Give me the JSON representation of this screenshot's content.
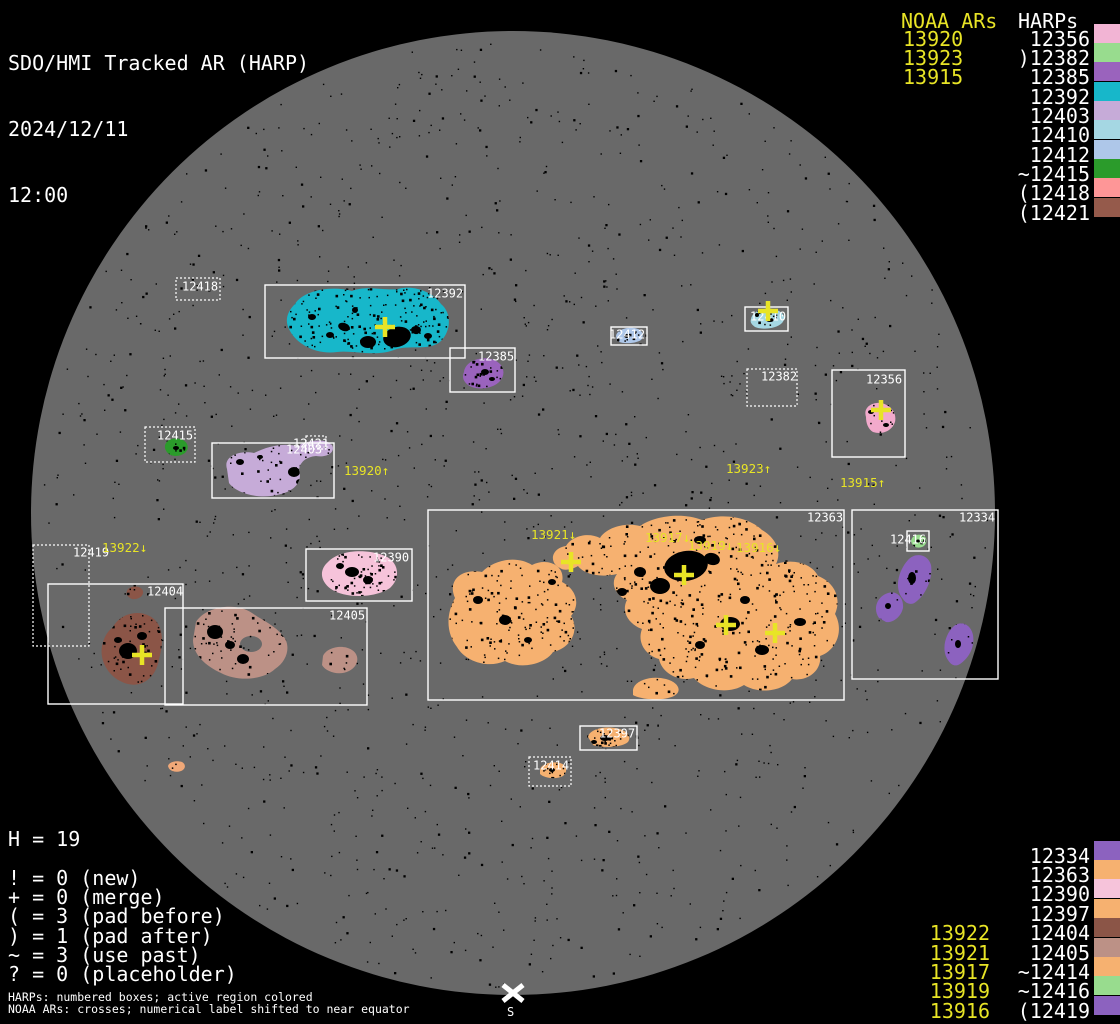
{
  "title": {
    "app": "SDO/HMI Tracked AR (HARP)",
    "date": "2024/12/11",
    "time": "12:00"
  },
  "colors": {
    "background": "#000000",
    "disk": "#696969",
    "noaa": "#e8e426",
    "harp_text": "#ffffff"
  },
  "legend_top_right": {
    "noaa_header": "NOAA ARs",
    "harps_header": "HARPs",
    "rows": [
      {
        "noaa": "13920",
        "harp": "12356",
        "color": "#f2b4d4"
      },
      {
        "noaa": "13923",
        "harp": ")12382",
        "color": "#98dc8e"
      },
      {
        "noaa": "13915",
        "harp": "12385",
        "color": "#9a63bd"
      },
      {
        "noaa": "",
        "harp": "12392",
        "color": "#17b7ca"
      },
      {
        "noaa": "",
        "harp": "12403",
        "color": "#c6abd8"
      },
      {
        "noaa": "",
        "harp": "12410",
        "color": "#a5d7e3"
      },
      {
        "noaa": "",
        "harp": "12412",
        "color": "#aec7e9"
      },
      {
        "noaa": "",
        "harp": "~12415",
        "color": "#2b9b2b"
      },
      {
        "noaa": "",
        "harp": "(12418",
        "color": "#fe9697"
      },
      {
        "noaa": "",
        "harp": "(12421",
        "color": "#955a4b"
      }
    ]
  },
  "legend_bottom_right": {
    "rows": [
      {
        "noaa": "",
        "harp": "12334",
        "color": "#8c62bf"
      },
      {
        "noaa": "",
        "harp": "12363",
        "color": "#f6b170"
      },
      {
        "noaa": "",
        "harp": "12390",
        "color": "#f6c3da"
      },
      {
        "noaa": "",
        "harp": "12397",
        "color": "#f6b170"
      },
      {
        "noaa": "13922",
        "harp": "12404",
        "color": "#8b5547"
      },
      {
        "noaa": "13921",
        "harp": "12405",
        "color": "#bc9186"
      },
      {
        "noaa": "13917",
        "harp": "~12414",
        "color": "#f6b170"
      },
      {
        "noaa": "13919",
        "harp": "~12416",
        "color": "#98dc8e"
      },
      {
        "noaa": "13916",
        "harp": "(12419",
        "color": "#8c62bf"
      }
    ]
  },
  "stats": {
    "title": "H = 19",
    "lines": [
      "! = 0 (new)",
      "+ = 0 (merge)",
      "( = 3 (pad before)",
      ") = 1 (pad after)",
      "~ = 3 (use past)",
      "? = 0 (placeholder)"
    ]
  },
  "footnotes": [
    "HARPs: numbered boxes; active region colored",
    "NOAA ARs: crosses; numerical label shifted to near equator"
  ],
  "south_marker": {
    "label": "S"
  },
  "disk": {
    "cx": 513,
    "cy": 513,
    "r": 482,
    "color": "#696969"
  },
  "noise": {
    "count": 1500,
    "seed": 7
  },
  "harp_boxes": [
    {
      "label": "12418",
      "x": 176,
      "y": 278,
      "w": 44,
      "h": 22,
      "style": "dotted",
      "lx": 182,
      "ly": 281
    },
    {
      "label": "12392",
      "x": 265,
      "y": 285,
      "w": 200,
      "h": 73,
      "style": "solid",
      "lx": 427,
      "ly": 288
    },
    {
      "label": "12385",
      "x": 450,
      "y": 348,
      "w": 65,
      "h": 44,
      "style": "solid",
      "lx": 478,
      "ly": 351
    },
    {
      "label": "12415",
      "x": 145,
      "y": 427,
      "w": 50,
      "h": 35,
      "style": "dotted",
      "lx": 157,
      "ly": 430
    },
    {
      "label": "12403",
      "x": 212,
      "y": 443,
      "w": 122,
      "h": 55,
      "style": "solid",
      "lx": 286,
      "ly": 444
    },
    {
      "label": "12421",
      "x": 306,
      "y": 436,
      "w": 20,
      "h": 13,
      "style": "dotted",
      "lx": 293,
      "ly": 438
    },
    {
      "label": "12419",
      "x": 33,
      "y": 545,
      "w": 56,
      "h": 101,
      "style": "dotted",
      "lx": 73,
      "ly": 547
    },
    {
      "label": "12404",
      "x": 48,
      "y": 584,
      "w": 135,
      "h": 120,
      "style": "solid",
      "lx": 147,
      "ly": 586
    },
    {
      "label": "12405",
      "x": 165,
      "y": 608,
      "w": 202,
      "h": 97,
      "style": "solid",
      "lx": 329,
      "ly": 610
    },
    {
      "label": "12390",
      "x": 306,
      "y": 549,
      "w": 106,
      "h": 52,
      "style": "solid",
      "lx": 373,
      "ly": 552
    },
    {
      "label": "12363",
      "x": 428,
      "y": 510,
      "w": 416,
      "h": 190,
      "style": "solid",
      "lx": 807,
      "ly": 512
    },
    {
      "label": "12334",
      "x": 852,
      "y": 510,
      "w": 146,
      "h": 169,
      "style": "solid",
      "lx": 959,
      "ly": 512
    },
    {
      "label": "12416",
      "x": 907,
      "y": 531,
      "w": 22,
      "h": 20,
      "style": "solid",
      "lx": 890,
      "ly": 534
    },
    {
      "label": "12356",
      "x": 832,
      "y": 370,
      "w": 73,
      "h": 87,
      "style": "solid",
      "lx": 866,
      "ly": 374
    },
    {
      "label": "12382",
      "x": 747,
      "y": 369,
      "w": 50,
      "h": 37,
      "style": "dotted",
      "lx": 761,
      "ly": 371
    },
    {
      "label": "12410",
      "x": 745,
      "y": 307,
      "w": 43,
      "h": 24,
      "style": "solid",
      "lx": 750,
      "ly": 311
    },
    {
      "label": "12412",
      "x": 611,
      "y": 327,
      "w": 36,
      "h": 18,
      "style": "solid",
      "lx": 609,
      "ly": 329
    },
    {
      "label": "12397",
      "x": 580,
      "y": 726,
      "w": 57,
      "h": 24,
      "style": "solid",
      "lx": 599,
      "ly": 728
    },
    {
      "label": "12414",
      "x": 529,
      "y": 757,
      "w": 42,
      "h": 29,
      "style": "dotted",
      "lx": 533,
      "ly": 760
    }
  ],
  "noaa_crosses": [
    [
      385,
      327
    ],
    [
      768,
      311
    ],
    [
      881,
      410
    ],
    [
      142,
      655
    ],
    [
      571,
      562
    ],
    [
      684,
      575
    ],
    [
      726,
      625
    ],
    [
      775,
      633
    ]
  ],
  "noaa_disk_labels": [
    {
      "text": "13920↑",
      "x": 344,
      "y": 465
    },
    {
      "text": "13922↓",
      "x": 102,
      "y": 542
    },
    {
      "text": "13921↓",
      "x": 531,
      "y": 529
    },
    {
      "text": "13917↓",
      "x": 645,
      "y": 532
    },
    {
      "text": "13919↓",
      "x": 688,
      "y": 540
    },
    {
      "text": "13916↓",
      "x": 736,
      "y": 542
    },
    {
      "text": "13923↑",
      "x": 726,
      "y": 463
    },
    {
      "text": "13915↑",
      "x": 840,
      "y": 477
    }
  ],
  "active_regions": [
    {
      "harp": "12392",
      "color": "#17b7ca",
      "speckles": 210,
      "paths": [
        "M295,304 C303,291 330,285 352,291 C366,285 386,291 398,289 C414,284 434,293 441,304 C452,313 451,331 441,341 C429,352 408,344 394,350 C376,357 352,350 337,352 C316,355 297,344 290,331 C284,321 287,312 295,304 Z"
      ],
      "clusters": [
        [
          397,
          337,
          14,
          10,
          -15
        ],
        [
          368,
          342,
          8,
          6,
          0
        ],
        [
          344,
          327,
          6,
          4,
          20
        ],
        [
          416,
          330,
          5,
          4,
          0
        ],
        [
          312,
          317,
          4,
          3,
          0
        ],
        [
          330,
          335,
          4,
          3,
          0
        ],
        [
          428,
          336,
          4,
          3,
          0
        ],
        [
          355,
          310,
          3,
          3,
          0
        ]
      ]
    },
    {
      "harp": "12385",
      "color": "#9a63bd",
      "speckles": 30,
      "paths": [
        "M464,372 C465,362 479,356 491,359 C503,362 507,373 500,381 C493,389 477,391 468,385 C463,381 462,377 464,372 Z"
      ],
      "clusters": [
        [
          485,
          372,
          4,
          3,
          0
        ],
        [
          492,
          379,
          3,
          2,
          0
        ]
      ]
    },
    {
      "harp": "12415",
      "color": "#2b9b2b",
      "speckles": 10,
      "paths": [
        "M165,448 C164,441 172,437 180,439 C188,441 190,448 185,453 C178,458 167,457 165,448 Z"
      ],
      "clusters": [
        [
          176,
          448,
          3,
          2,
          0
        ]
      ]
    },
    {
      "harp": "12403",
      "color": "#c6abd8",
      "speckles": 55,
      "paths": [
        "M227,469 C223,457 238,450 254,453 C268,446 283,443 297,446 C308,440 326,438 332,445 C336,452 327,458 316,456 C306,457 300,462 299,470 C303,482 294,492 277,495 C259,499 237,494 229,483 Z"
      ],
      "clusters": [
        [
          294,
          472,
          6,
          5,
          0
        ],
        [
          300,
          482,
          4,
          3,
          0
        ],
        [
          240,
          462,
          4,
          3,
          0
        ],
        [
          260,
          457,
          3,
          2,
          0
        ]
      ]
    },
    {
      "harp": "12390",
      "color": "#f6c3da",
      "speckles": 80,
      "paths": [
        "M328,562 C339,550 366,548 385,556 C399,562 401,578 390,588 C376,598 345,599 331,589 C320,581 319,570 328,562 Z"
      ],
      "clusters": [
        [
          352,
          572,
          7,
          5,
          0
        ],
        [
          368,
          580,
          5,
          4,
          0
        ],
        [
          340,
          566,
          4,
          3,
          0
        ]
      ]
    },
    {
      "harp": "12404",
      "color": "#8b5547",
      "speckles": 100,
      "paths": [
        "M113,627 C121,612 143,608 155,620 C164,629 163,646 159,659 C157,674 145,688 128,684 C111,680 99,663 102,646 C104,637 107,632 113,627 Z",
        "M128,589 C133,585 141,586 143,591 C144,596 138,600 132,599 C127,597 125,593 128,589 Z"
      ],
      "clusters": [
        [
          128,
          651,
          9,
          8,
          0
        ],
        [
          142,
          636,
          5,
          4,
          0
        ],
        [
          118,
          640,
          4,
          3,
          0
        ]
      ]
    },
    {
      "harp": "12405",
      "color": "#bc9186",
      "speckles": 120,
      "paths": [
        "M196,622 C206,606 236,602 252,613 C262,620 276,626 284,637 C291,647 287,661 275,669 C263,680 238,682 221,673 C206,666 193,655 193,640 Z",
        "M323,656 C327,647 343,644 352,650 C360,655 359,666 349,671 C339,676 326,672 322,665 Z"
      ],
      "holes": [
        [
          251,
          644,
          11,
          8
        ]
      ],
      "clusters": [
        [
          215,
          632,
          8,
          7,
          0
        ],
        [
          243,
          659,
          6,
          5,
          0
        ],
        [
          230,
          645,
          5,
          4,
          0
        ]
      ]
    },
    {
      "harp": "12363",
      "color": "#f6b170",
      "speckles": 900,
      "paths": [
        "M455,598 C447,580 462,568 482,572 C494,560 516,555 532,565 C548,557 566,566 562,582 C576,589 581,604 571,616 C580,630 571,648 553,652 C545,664 521,670 505,661 C487,669 465,661 457,647 C446,633 446,614 455,598 Z",
        "M560,568 C548,562 552,548 566,546 C572,536 588,532 600,538 C606,528 624,522 640,526 C654,516 682,512 702,520 C724,512 750,518 762,530 C776,538 782,552 776,564 C794,558 812,564 818,576 C834,582 842,598 835,614 C844,630 837,650 820,656 C822,670 808,682 792,679 C782,692 758,694 744,685 C728,695 704,690 694,678 C678,682 662,673 659,659 C645,655 637,642 642,629 C628,624 621,611 627,600 C615,595 610,583 617,574 C600,578 584,574 578,566 C571,570 564,571 560,568 Z",
        "M633,690 C634,681 650,675 666,679 C678,682 683,691 674,696 C661,702 640,699 633,695 Z"
      ],
      "clusters": [
        [
          686,
          566,
          22,
          15,
          -10
        ],
        [
          660,
          586,
          10,
          8,
          0
        ],
        [
          712,
          559,
          8,
          6,
          15
        ],
        [
          700,
          540,
          6,
          4,
          0
        ],
        [
          640,
          572,
          6,
          5,
          0
        ],
        [
          622,
          592,
          5,
          4,
          0
        ],
        [
          730,
          624,
          10,
          7,
          0
        ],
        [
          762,
          650,
          7,
          5,
          0
        ],
        [
          800,
          622,
          6,
          4,
          0
        ],
        [
          700,
          645,
          5,
          4,
          0
        ],
        [
          745,
          600,
          5,
          4,
          0
        ],
        [
          505,
          620,
          6,
          5,
          0
        ],
        [
          478,
          600,
          5,
          4,
          0
        ],
        [
          528,
          640,
          4,
          3,
          0
        ],
        [
          552,
          582,
          4,
          3,
          0
        ]
      ]
    },
    {
      "harp": "12334",
      "color": "#8c62bf",
      "speckles": 60,
      "paths": [
        "M903,599 C894,589 898,571 908,560 C915,552 928,554 931,565 C933,577 927,593 917,601 C912,606 906,604 903,599 Z",
        "M879,618 C872,608 878,596 888,593 C897,590 904,598 903,608 C901,617 893,623 886,622 Z",
        "M948,660 C941,650 945,634 954,626 C962,620 971,625 973,635 C975,647 969,658 960,664 C955,667 951,665 948,660 Z"
      ],
      "clusters": [
        [
          912,
          578,
          4,
          6,
          0
        ],
        [
          888,
          606,
          3,
          3,
          0
        ],
        [
          958,
          644,
          3,
          4,
          0
        ]
      ]
    },
    {
      "harp": "12356",
      "color": "#f2aacc",
      "speckles": 18,
      "paths": [
        "M866,417 C863,408 871,402 881,403 C891,405 897,413 895,422 C892,431 882,435 873,432 C868,429 866,423 866,417 Z"
      ],
      "clusters": [
        [
          871,
          412,
          3,
          2,
          0
        ],
        [
          886,
          425,
          3,
          2,
          0
        ]
      ]
    },
    {
      "harp": "12410",
      "color": "#a5d7e3",
      "speckles": 14,
      "paths": [
        "M751,319 C752,312 763,307 773,309 C783,311 787,317 782,323 C776,329 762,330 755,327 C751,324 750,322 751,319 Z"
      ],
      "clusters": [
        [
          770,
          320,
          4,
          2,
          0
        ],
        [
          757,
          315,
          2,
          2,
          0
        ]
      ]
    },
    {
      "harp": "12412",
      "color": "#aec7e9",
      "speckles": 10,
      "paths": [
        "M616,336 C617,330 626,327 634,328 C642,329 645,335 641,340 C635,344 622,344 617,341 Z"
      ],
      "clusters": [
        [
          627,
          336,
          3,
          2,
          0
        ]
      ]
    },
    {
      "harp": "12397",
      "color": "#f6b170",
      "speckles": 26,
      "paths": [
        "M588,737 C589,730 602,726 615,728 C627,730 632,736 628,742 C621,748 602,748 593,745 Z"
      ],
      "clusters": [
        [
          605,
          738,
          5,
          3,
          0
        ],
        [
          594,
          742,
          3,
          2,
          0
        ]
      ]
    },
    {
      "harp": "12414",
      "color": "#f6b170",
      "speckles": 12,
      "paths": [
        "M540,770 C541,764 551,761 560,763 C567,765 568,772 563,776 C556,780 544,778 540,774 Z"
      ],
      "clusters": [
        [
          552,
          770,
          3,
          2,
          0
        ]
      ]
    },
    {
      "harp": "12416",
      "color": "#98dc8e",
      "speckles": 4,
      "paths": [
        "M911,541 C912,535 919,533 924,536 C928,539 927,545 922,547 C916,549 912,546 911,541 Z"
      ],
      "clusters": [
        [
          918,
          541,
          2,
          1.5,
          0
        ]
      ]
    },
    {
      "harp": "",
      "color": "#f0a878",
      "speckles": 3,
      "paths": [
        "M168,766 C169,762 176,760 182,762 C186,764 186,769 181,771 C175,773 169,771 168,766 Z"
      ],
      "clusters": []
    }
  ]
}
